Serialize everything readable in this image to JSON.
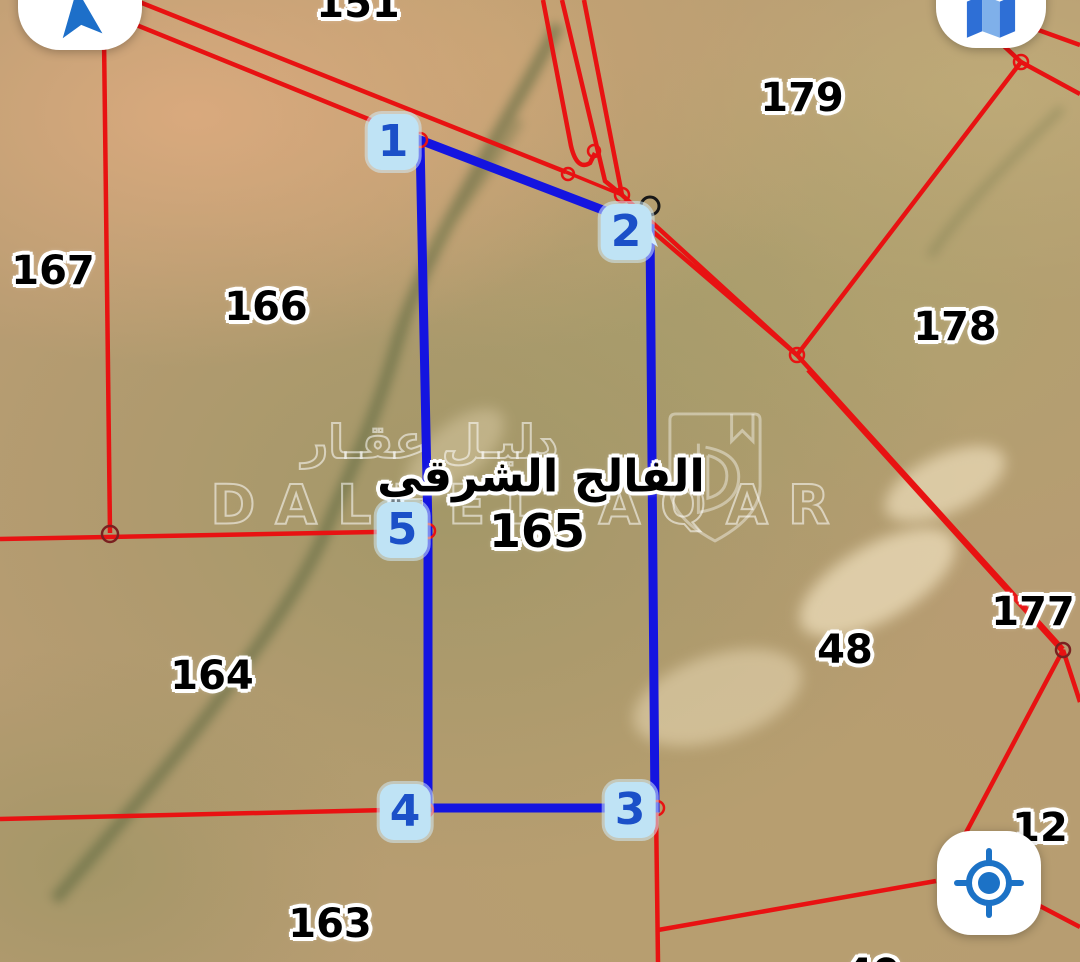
{
  "map": {
    "view_type": "satellite"
  },
  "place": {
    "name_ar": "الفالج الشرقي",
    "number": "165"
  },
  "parcels": [
    "151",
    "167",
    "166",
    "179",
    "178",
    "177",
    "164",
    "163",
    "48",
    "12",
    "49"
  ],
  "vertices": [
    "1",
    "2",
    "3",
    "4",
    "5"
  ],
  "watermark": {
    "brand_latin": "DALEEL AQAR",
    "brand_ar": "دليـل عقـار",
    "logo": "shield-d-logo"
  },
  "controls": {
    "compass": "navigation-arrow-icon",
    "map_type": "map-icon",
    "my_location": "my-location-crosshair-icon"
  },
  "colors": {
    "red_boundary": "#e81212",
    "blue_highlight": "#1414e0",
    "vertex_badge_bg": "#bfe3f5",
    "vertex_digit": "#1b50c8",
    "label_text": "#000000",
    "label_outline": "#ffffff",
    "button_bg": "#ffffff",
    "button_icon": "#1d6fc9"
  }
}
